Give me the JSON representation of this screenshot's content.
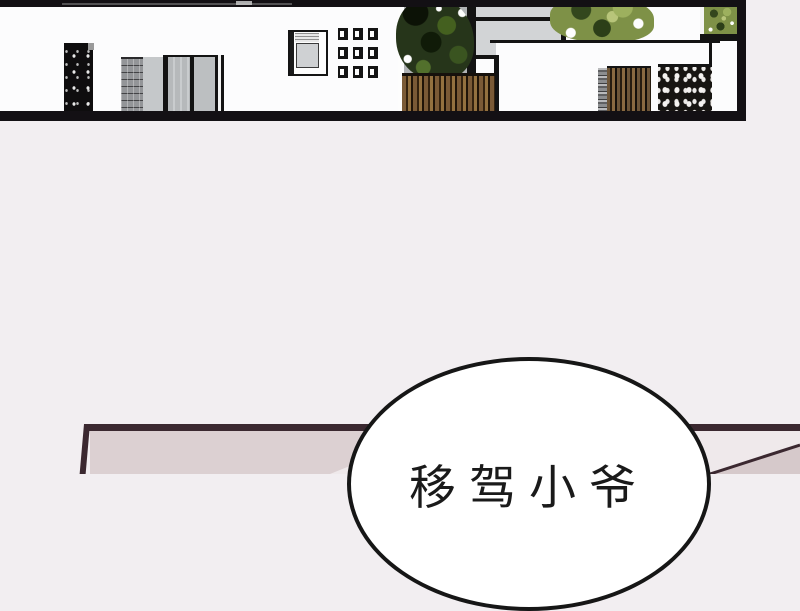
{
  "page": {
    "background_color": "#f2eef1"
  },
  "dialog": {
    "bubble_text_visible": "移驾小爷",
    "text_color": "#1a1a1a",
    "bubble_fill": "#ffffff",
    "bubble_border_color": "#161616"
  },
  "architecture_panel": {
    "objects": [
      "bookshelf",
      "stone-pillar",
      "wardrobe-panels",
      "wall-cabinet",
      "wall-tile-grid",
      "glass-partition",
      "indoor-tree-dark",
      "wood-slat-planter",
      "white-counter",
      "indoor-tree-light",
      "wall-planter-box",
      "stone-strip",
      "wood-slat-panel",
      "perforated-screen"
    ],
    "colors": {
      "room_white": "#fcfcfd",
      "ceiling_floor_black": "#131014",
      "glass_gray": "#c7cacc",
      "stone_gray": "#939598",
      "wood_brown": "#7a5a36",
      "foliage_dark": "#26351a",
      "foliage_light": "#7e9147"
    }
  },
  "bottom_panel": {
    "border_color": "#3b2830",
    "wall_fill": "#dcd0d2",
    "light_fill": "#efe9eb",
    "corner_wedge_fill": "#d6c9cb"
  }
}
